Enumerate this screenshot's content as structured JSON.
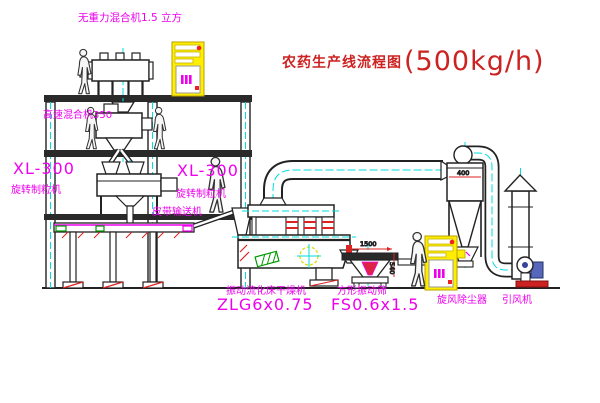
{
  "title": {
    "text": "农药生产线流程图",
    "capacity": "(500kg/h)"
  },
  "equipment_labels": {
    "gravity_mixer": "无重力混合机1.5 立方",
    "high_speed_mixer": "高速混合机350",
    "granulator_left": {
      "model": "XL-300",
      "name": "旋转制粒机"
    },
    "granulator_right": {
      "model": "XL-300",
      "name": "旋转制粒机"
    },
    "belt_conveyor": "皮带输送机",
    "fluid_bed_dryer": {
      "name": "振动流化床干燥机",
      "model": "ZLG6x0.75"
    },
    "vibrating_sieve": {
      "name": "方形振动筛",
      "model": "FS0.6x1.5"
    },
    "cyclone": "旋风除尘器",
    "induced_draft_fan": "引风机"
  },
  "dimensions": {
    "cyclone_width": "400",
    "sieve_length": "1500",
    "sieve_height": "540"
  },
  "colors": {
    "label_magenta": "#ee00ee",
    "title_red": "#cc2222",
    "centerline_cyan": "#00dede",
    "cabinet_yellow": "#ffee00",
    "accent_red": "#dd2222",
    "accent_green": "#009900",
    "line_dark": "#222222"
  }
}
